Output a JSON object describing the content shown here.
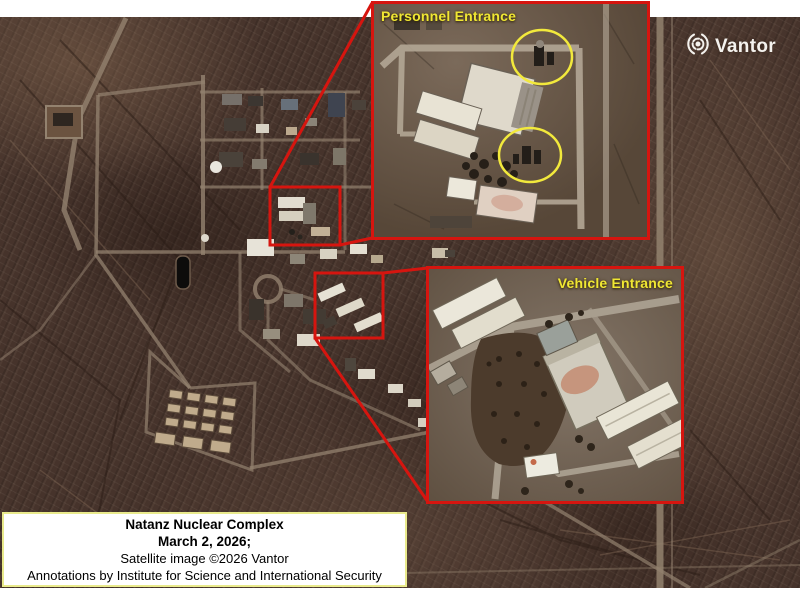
{
  "image_title": "Natanz Nuclear Complex satellite overview",
  "logo": {
    "brand": "Vantor",
    "icon": "vantor-aperture-icon",
    "color": "#f4f2ee"
  },
  "insets": {
    "personnel": {
      "label": "Personnel Entrance"
    },
    "vehicle": {
      "label": "Vehicle Entrance"
    }
  },
  "caption": {
    "line1": "Natanz Nuclear Complex",
    "line2": "March 2, 2026;",
    "line3": "Satellite image ©2026 Vantor",
    "line4": "Annotations by Institute for Science and International Security"
  },
  "colors": {
    "annotation_red": "#d6150f",
    "annotation_yellow": "#f0e733",
    "caption_border": "#e9ea8c",
    "terrain_base": "#46332b",
    "page_background": "#ffffff"
  }
}
